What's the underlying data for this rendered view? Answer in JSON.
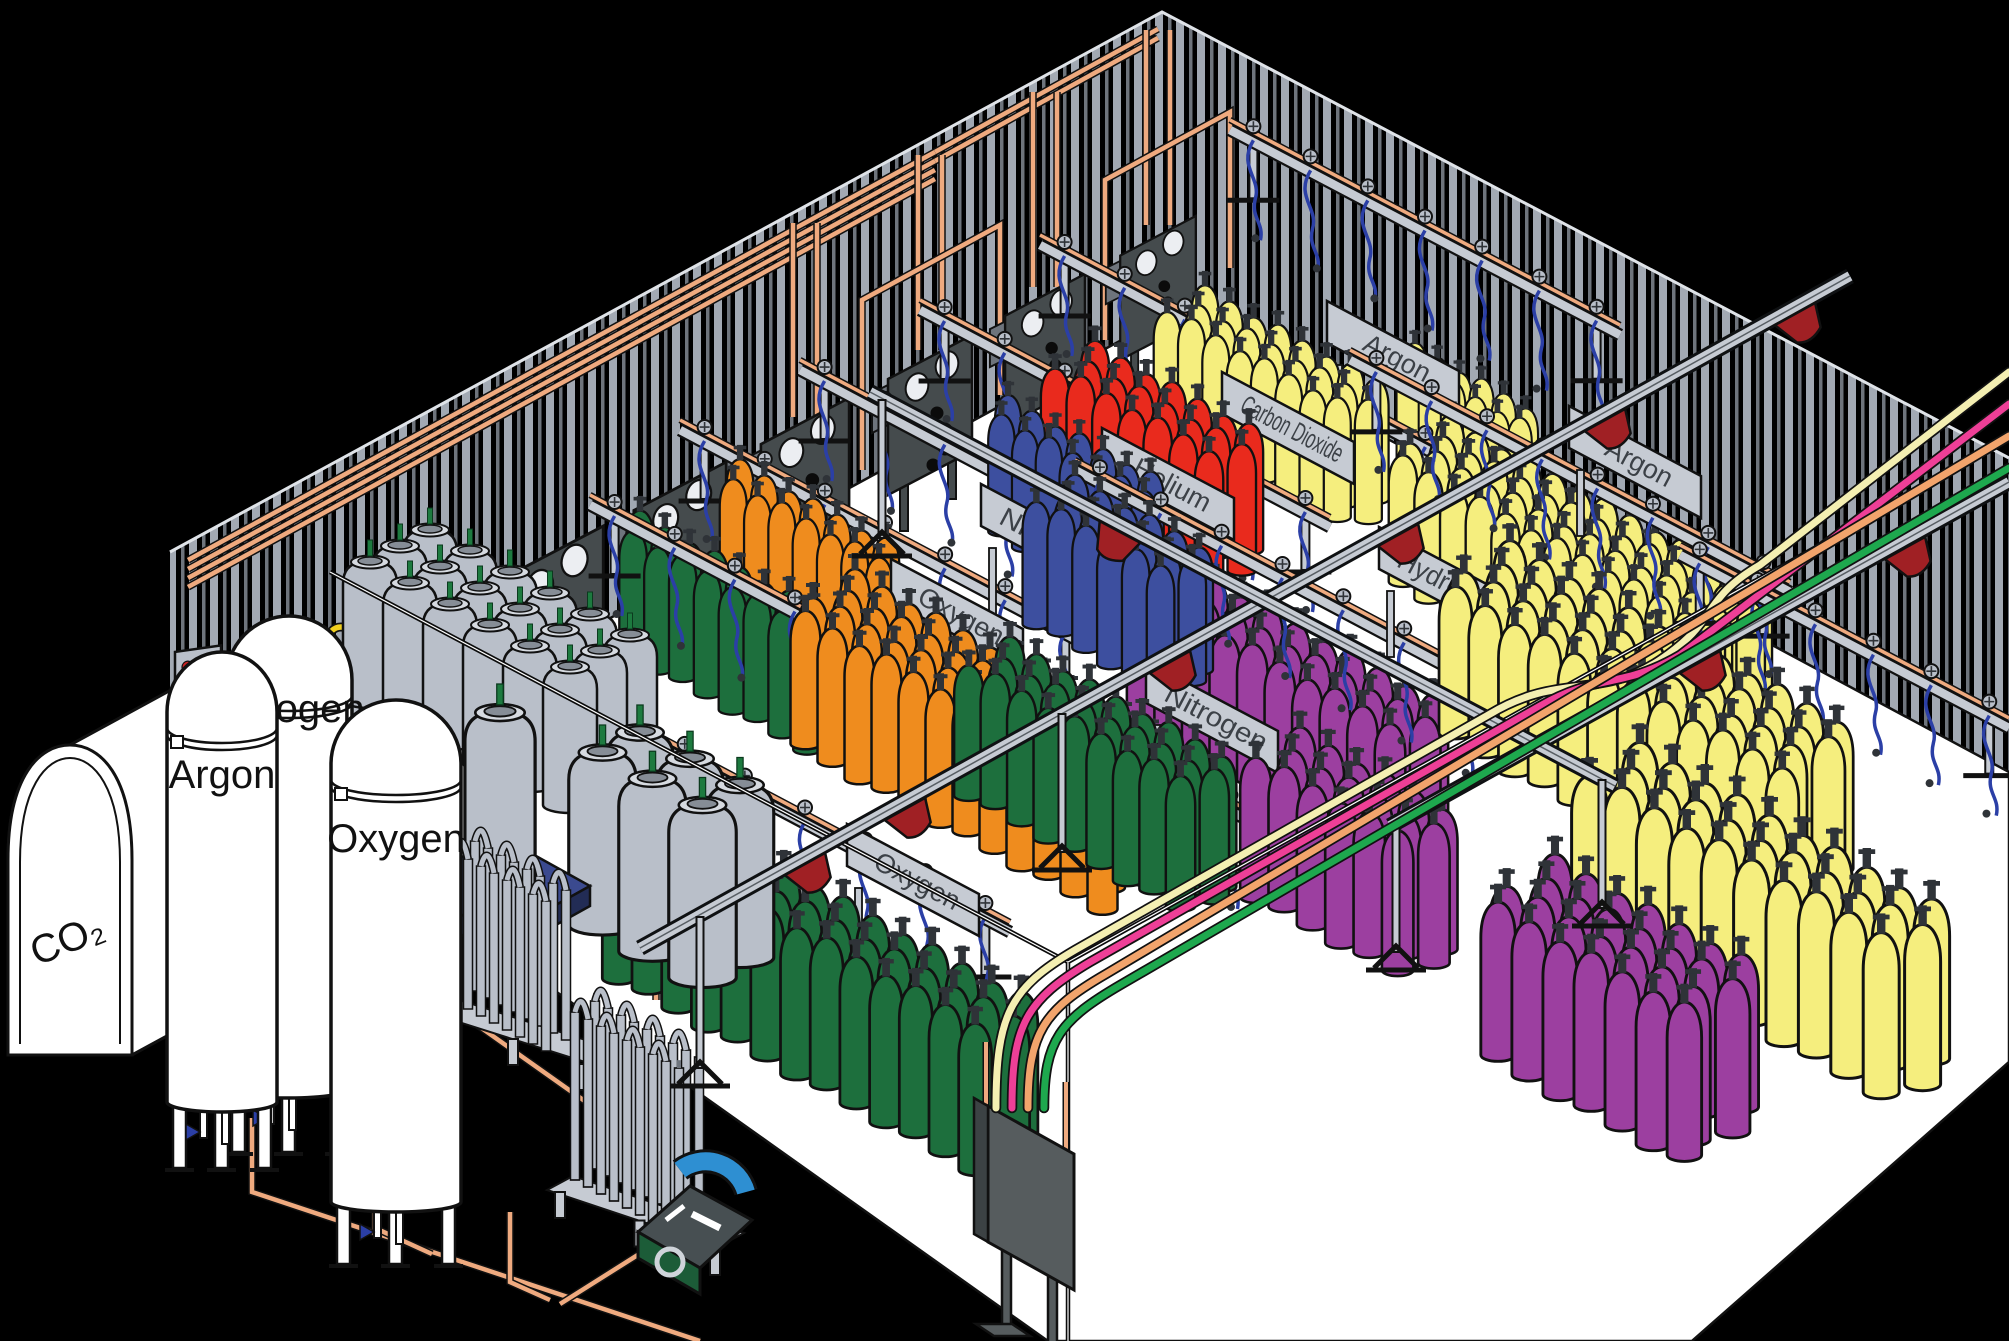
{
  "diagram": {
    "kind": "isometric-industrial-gas-filling-plant",
    "background": "#000000",
    "floor_color": "#ffffff"
  },
  "palette": {
    "green": "#1d6f3d",
    "orange": "#ef8c1e",
    "blue": "#3d4f9f",
    "red": "#e92a1d",
    "yellow": "#f5ee7e",
    "purple": "#9c3fa0",
    "grayCyl": "#b9bfc9",
    "copper": "#efaa7f",
    "rail": "#c6cbd3",
    "steel": "#454b4d",
    "trolley": "#a02024",
    "sign": "#c6cbd3",
    "wallStripe": "#a2a9b3",
    "wallStripe2": "#6e747c",
    "hose": "#2b3fa6",
    "palletBlue": "#3b4a8f",
    "pumpBlue": "#2e8fd2",
    "pumpGreen": "#1c5c38",
    "valveGreen": "#1d7a3f",
    "ribbonCream": "#f4efb2",
    "ribbonPink": "#ee3f97",
    "ribbonOrange": "#f2a46c",
    "ribbonGreen": "#1ea84e"
  },
  "storage_tanks": [
    {
      "label": "CO₂",
      "kind": "horizontal",
      "labelX": 72,
      "labelY": 952,
      "labelRot": -22
    },
    {
      "label": "Argon",
      "kind": "vertical",
      "cx": 222,
      "hw": 55,
      "top": 652,
      "shoulder": 712,
      "base": 1102,
      "legH": 66,
      "labelY": 788
    },
    {
      "label": "Nitrogen",
      "kind": "vertical",
      "cx": 289,
      "hw": 63,
      "top": 616,
      "shoulder": 680,
      "base": 1088,
      "legH": 64,
      "labelY": 722
    },
    {
      "label": "Oxygen",
      "kind": "vertical",
      "cx": 396,
      "hw": 65,
      "top": 700,
      "shoulder": 764,
      "base": 1202,
      "legH": 62,
      "labelY": 852
    }
  ],
  "station_signs": [
    {
      "gas": "Oxygen",
      "x": 957,
      "y": 615
    },
    {
      "gas": "Nitrogen",
      "x": 1047,
      "y": 540
    },
    {
      "gas": "Helium",
      "x": 1168,
      "y": 484
    },
    {
      "gas": "Carbon Dioxide",
      "x": 1288,
      "y": 428
    },
    {
      "gas": "Argon",
      "x": 1393,
      "y": 357
    },
    {
      "gas": "Nitrogen",
      "x": 1212,
      "y": 717
    },
    {
      "gas": "Hydrogen",
      "x": 1445,
      "y": 583
    },
    {
      "gas": "Argon",
      "x": 1635,
      "y": 462
    },
    {
      "gas": "Oxygen",
      "x": 913,
      "y": 880
    }
  ],
  "scene_items": [
    {
      "t": "rail",
      "x1": 1230,
      "y1": 130,
      "x2": 1620,
      "y2": 335,
      "valves": 7
    },
    {
      "t": "cluster",
      "gas": "argon",
      "color": "yellow",
      "x": 1415,
      "y": 455,
      "n1": 6,
      "n2": 2,
      "s": 0.82
    },
    {
      "t": "rail",
      "x1": 1040,
      "y1": 245,
      "x2": 1450,
      "y2": 462,
      "valves": 7
    },
    {
      "t": "sign",
      "i": 4
    },
    {
      "t": "cluster",
      "gas": "carbon-dioxide",
      "color": "yellow",
      "x": 1205,
      "y": 408,
      "n1": 8,
      "n2": 3,
      "s": 0.9
    },
    {
      "t": "rail",
      "x1": 920,
      "y1": 310,
      "x2": 1330,
      "y2": 527,
      "valves": 7
    },
    {
      "t": "sign",
      "i": 3
    },
    {
      "t": "cluster",
      "gas": "helium",
      "color": "red",
      "x": 1095,
      "y": 470,
      "n1": 7,
      "n2": 3,
      "s": 0.95
    },
    {
      "t": "rail",
      "x1": 800,
      "y1": 370,
      "x2": 1210,
      "y2": 587,
      "valves": 7
    },
    {
      "t": "sign",
      "i": 2
    },
    {
      "t": "cluster",
      "gas": "nitrogen",
      "color": "blue",
      "x": 1008,
      "y": 515,
      "n1": 7,
      "n2": 2,
      "s": 0.88
    },
    {
      "t": "rail",
      "x1": 680,
      "y1": 430,
      "x2": 1090,
      "y2": 647,
      "valves": 7
    },
    {
      "t": "sign",
      "i": 1
    },
    {
      "t": "cluster",
      "gas": "nitrogen",
      "color": "orange",
      "x": 740,
      "y": 582,
      "n1": 7,
      "n2": 2,
      "s": 0.9
    },
    {
      "t": "cluster",
      "gas": "oxygen",
      "color": "green",
      "x": 640,
      "y": 636,
      "n1": 8,
      "n2": 2,
      "s": 0.92
    },
    {
      "t": "rail",
      "x1": 590,
      "y1": 505,
      "x2": 1000,
      "y2": 722,
      "valves": 7
    },
    {
      "t": "sign",
      "i": 0
    },
    {
      "t": "cluster",
      "gas": "argon",
      "color": "yellow",
      "x": 1450,
      "y": 545,
      "n1": 13,
      "n2": 4,
      "s": 0.95
    },
    {
      "t": "rail",
      "x1": 1350,
      "y1": 360,
      "x2": 1790,
      "y2": 592,
      "valves": 8
    },
    {
      "t": "sign",
      "i": 7
    },
    {
      "t": "rail",
      "x1": 1680,
      "y1": 555,
      "x2": 2009,
      "y2": 728,
      "valves": 6
    },
    {
      "t": "cluster",
      "gas": "hydrogen",
      "color": "purple",
      "x": 1185,
      "y": 700,
      "n1": 10,
      "n2": 3,
      "s": 1.02
    },
    {
      "t": "rail",
      "x1": 1075,
      "y1": 470,
      "x2": 1490,
      "y2": 690,
      "valves": 7
    },
    {
      "t": "sign",
      "i": 6
    },
    {
      "t": "cluster",
      "gas": "nitrogen",
      "color": "blue",
      "x": 1075,
      "y": 600,
      "n1": 6,
      "n2": 3,
      "s": 0.92
    },
    {
      "t": "rail",
      "x1": 845,
      "y1": 607,
      "x2": 1255,
      "y2": 824,
      "valves": 7
    },
    {
      "t": "sign",
      "i": 5
    },
    {
      "t": "cluster",
      "gas": "nitrogen",
      "color": "orange",
      "x": 855,
      "y": 705,
      "n1": 12,
      "n2": 4,
      "s": 1.0
    },
    {
      "t": "cluster",
      "gas": "argon",
      "color": "yellow",
      "x": 1510,
      "y": 690,
      "n1": 12,
      "n2": 4,
      "s": 1.1
    },
    {
      "t": "cluster",
      "gas": "oxygen",
      "color": "green",
      "x": 1010,
      "y": 770,
      "n1": 9,
      "n2": 3,
      "s": 0.98
    },
    {
      "t": "rail",
      "x1": 600,
      "y1": 715,
      "x2": 1010,
      "y2": 932,
      "valves": 7
    },
    {
      "t": "sign",
      "i": 8
    },
    {
      "t": "cluster",
      "gas": "oxygen",
      "color": "green",
      "x": 665,
      "y": 950,
      "n1": 13,
      "n2": 3,
      "s": 1.1
    },
    {
      "t": "cluster",
      "gas": "argon",
      "color": "yellow",
      "x": 1640,
      "y": 905,
      "n1": 10,
      "n2": 3,
      "s": 1.2
    },
    {
      "t": "cluster",
      "gas": "hydrogen",
      "color": "purple",
      "x": 1300,
      "y": 870,
      "n1": 6,
      "n2": 3,
      "s": 1.05
    },
    {
      "t": "cluster",
      "gas": "hydrogen",
      "color": "purple",
      "x": 1555,
      "y": 1010,
      "n1": 7,
      "n2": 4,
      "s": 1.15
    },
    {
      "t": "bulkgroup",
      "x": 430,
      "y": 668,
      "n1": 6,
      "n2": 3,
      "s": 1.0
    },
    {
      "t": "bulkgroup",
      "x": 640,
      "y": 905,
      "n1": 3,
      "n2": 2,
      "s": 1.25
    },
    {
      "t": "palletcyl",
      "x": 500,
      "y": 892
    },
    {
      "t": "rack",
      "x": 455,
      "y": 1002,
      "n": 8,
      "rows": 2,
      "h": 150
    },
    {
      "t": "rack",
      "x": 575,
      "y": 1180,
      "n": 9,
      "rows": 2,
      "h": 168
    },
    {
      "t": "pump",
      "x": 700,
      "y": 1222
    },
    {
      "t": "cable",
      "d": "M330 572 L1068 962"
    },
    {
      "t": "cable",
      "d": "M1068 962 L1068 1341"
    },
    {
      "t": "cable",
      "d": "M1068 962 L2009 440"
    },
    {
      "t": "beam",
      "x1": 640,
      "y1": 948,
      "x2": 1850,
      "y2": 276
    },
    {
      "t": "beam",
      "x1": 1390,
      "y1": 826,
      "x2": 2009,
      "y2": 482
    },
    {
      "t": "beam",
      "x1": 870,
      "y1": 392,
      "x2": 1615,
      "y2": 786
    },
    {
      "t": "post",
      "x": 700,
      "y1": 917,
      "y2": 1068
    },
    {
      "t": "post",
      "x": 1062,
      "y1": 714,
      "y2": 852
    },
    {
      "t": "post",
      "x": 882,
      "y1": 400,
      "y2": 538
    },
    {
      "t": "post",
      "x": 1602,
      "y1": 780,
      "y2": 908
    },
    {
      "t": "post",
      "x": 1396,
      "y1": 824,
      "y2": 952
    },
    {
      "t": "trolley",
      "x": 805,
      "y": 856,
      "a": -29
    },
    {
      "t": "trolley",
      "x": 905,
      "y": 801,
      "a": -29
    },
    {
      "t": "trolley",
      "x": 1170,
      "y": 654,
      "a": -29
    },
    {
      "t": "trolley",
      "x": 1398,
      "y": 527,
      "a": -29
    },
    {
      "t": "trolley",
      "x": 1605,
      "y": 412,
      "a": -29
    },
    {
      "t": "trolley",
      "x": 1795,
      "y": 306,
      "a": -29
    },
    {
      "t": "trolley",
      "x": 1700,
      "y": 654,
      "a": -29
    },
    {
      "t": "trolley",
      "x": 1905,
      "y": 540,
      "a": -29
    },
    {
      "t": "trolley",
      "x": 1120,
      "y": 524,
      "a": 28
    },
    {
      "t": "fillpanel",
      "x": 988,
      "y": 1106
    },
    {
      "t": "ribbon",
      "color": "ribbonCream",
      "d": "M996 1108 C996 1015 1010 988 1075 950 L1490 714 C1560 672 1600 700 1660 660 C1720 620 1700 600 1760 565 L2009 372"
    },
    {
      "t": "ribbon",
      "color": "ribbonPink",
      "d": "M1012 1108 C1012 1025 1026 1000 1090 962 L1540 706 C1600 672 1620 690 1680 655 L2009 404"
    },
    {
      "t": "ribbon",
      "color": "ribbonOrange",
      "d": "M1028 1108 C1028 1032 1044 1010 1106 974 L2009 436"
    },
    {
      "t": "ribbon",
      "color": "ribbonGreen",
      "d": "M1044 1108 C1044 1040 1060 1020 1122 984 L2009 468"
    },
    {
      "t": "tank",
      "i": 0
    },
    {
      "t": "tank",
      "i": 2
    },
    {
      "t": "tank",
      "i": 1
    },
    {
      "t": "tank",
      "i": 3
    }
  ],
  "copper_runs": [
    "M188 560 L935 152",
    "M188 569 L935 161",
    "M188 578 L935 170",
    "M188 587 L935 179",
    "M935 152 L1158 29",
    "M935 161 L1158 38",
    "M793 417 L793 223",
    "M817 417 L817 223",
    "M918 350 L918 155",
    "M942 350 L942 155",
    "M1033 287 L1033 92",
    "M1057 287 L1057 92",
    "M1146 225 L1146 30",
    "M1170 225 L1170 30",
    "M862 470 L862 300 L1000 225 L1000 395",
    "M1105 340 L1105 180 L1230 112 L1230 268",
    "M656 1000 L656 886 L788 876",
    "M664 1000 L664 894 L788 884",
    "M672 1000 L672 902 L788 892",
    "M252 1118 L252 1192 L700 1341",
    "M375 1158 L375 1228 L432 1254",
    "M510 1212 L510 1282 L550 1300",
    "M560 1304 L652 1246",
    "M148 792 L620 1126 L656 1150"
  ],
  "wall_panels": [
    {
      "x": 555,
      "y": 618,
      "s": 1.15
    },
    {
      "x": 680,
      "y": 550,
      "s": 1.1
    },
    {
      "x": 805,
      "y": 482,
      "s": 1.05
    },
    {
      "x": 930,
      "y": 415,
      "s": 1.0
    },
    {
      "x": 1045,
      "y": 350,
      "s": 0.95
    },
    {
      "x": 1158,
      "y": 288,
      "s": 0.9
    }
  ],
  "control_boxes": [
    {
      "x": 175,
      "y": 652,
      "w": 46,
      "h": 56,
      "dots": 4
    },
    {
      "x": 352,
      "y": 666,
      "w": 44,
      "h": 52,
      "dots": 2
    }
  ],
  "pigtail_sets": [
    {
      "beam": [
        243,
        726,
        482,
        616
      ],
      "pts": [
        [
          255,
          712
        ],
        [
          298,
          692
        ],
        [
          341,
          672
        ],
        [
          384,
          652
        ],
        [
          427,
          632
        ],
        [
          470,
          612
        ]
      ]
    },
    {
      "beam": [
        55,
        966,
        208,
        874
      ],
      "pts": [
        [
          65,
          952
        ],
        [
          108,
          930
        ],
        [
          151,
          908
        ],
        [
          194,
          886
        ]
      ]
    }
  ]
}
